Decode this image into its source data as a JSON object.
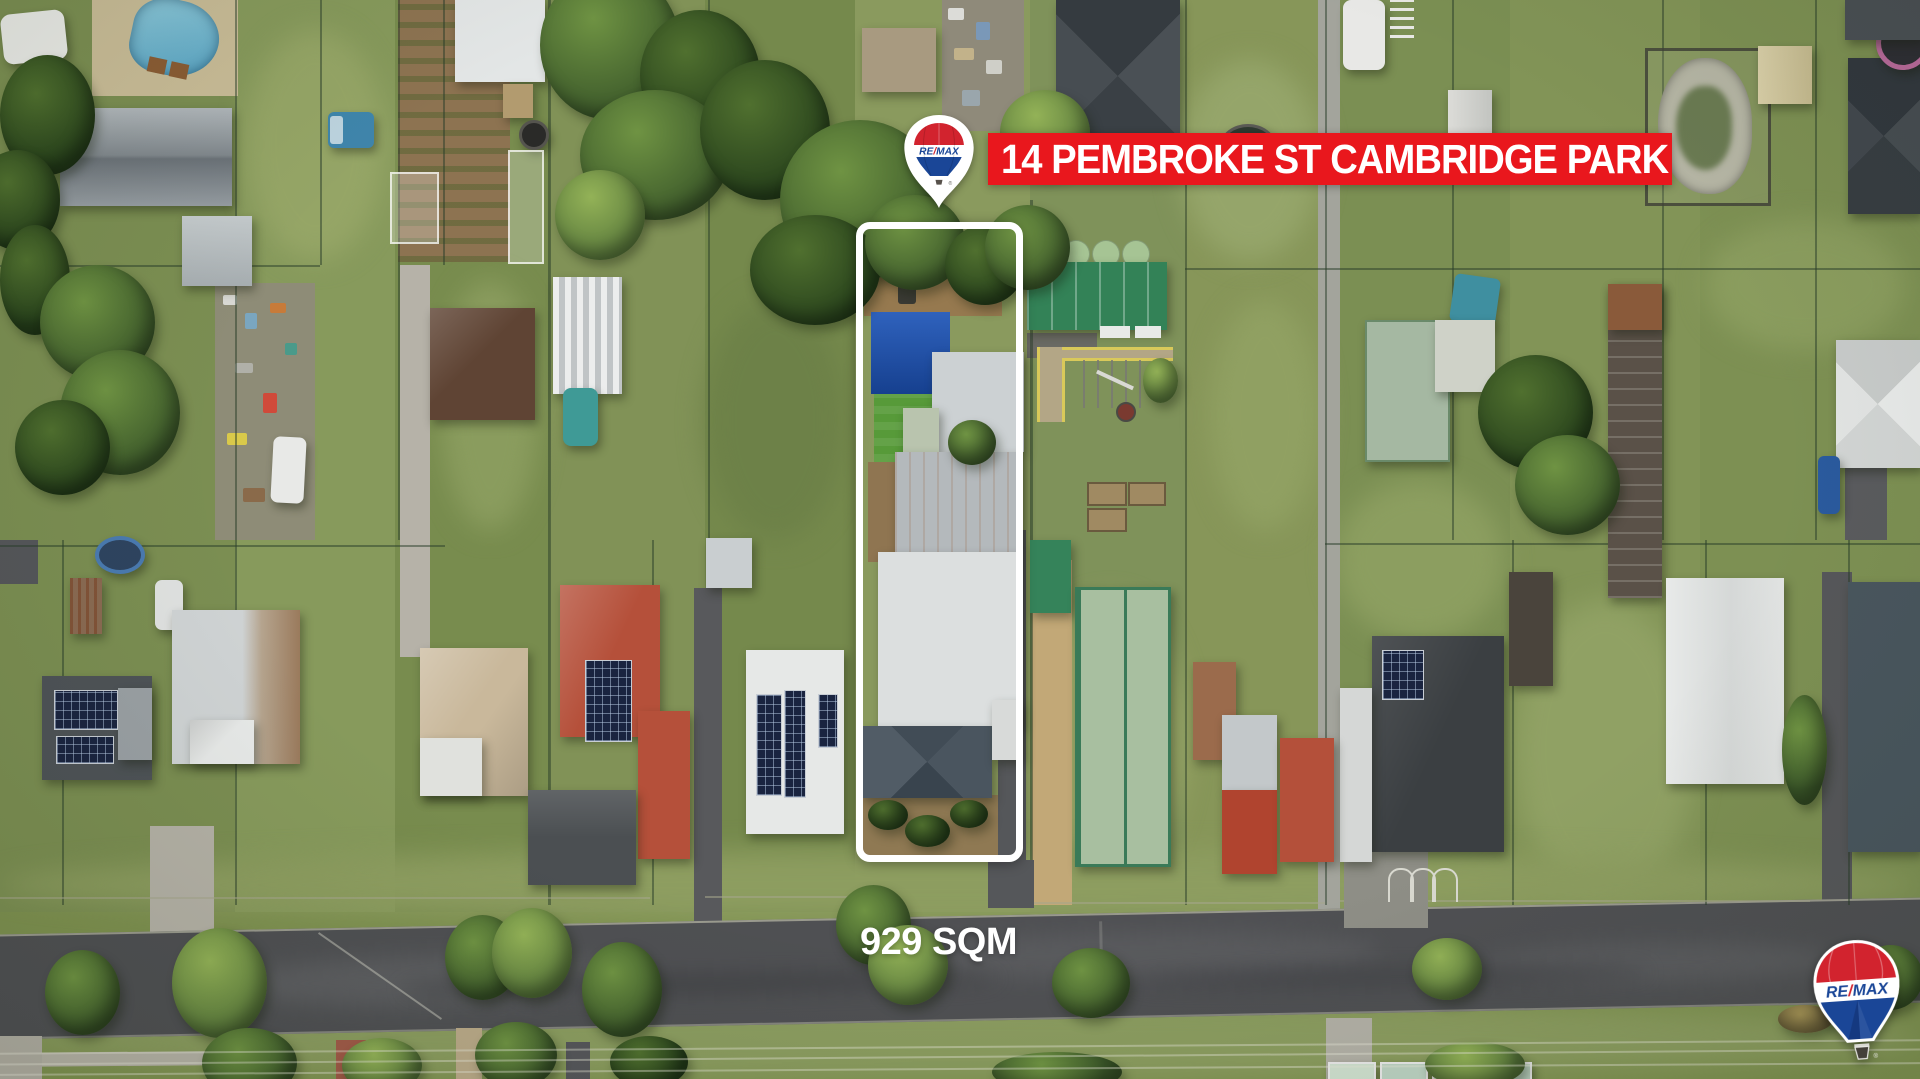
{
  "overlay": {
    "address_banner": "14 PEMBROKE ST CAMBRIDGE PARK",
    "area_label": "929 SQM",
    "brand": {
      "re": "RE",
      "slash": "/",
      "max": "MAX",
      "registered": "®"
    },
    "colors": {
      "banner_red": "#e9171d",
      "brand_red": "#d2232e",
      "brand_blue": "#1a4697",
      "boundary_white": "#ffffff",
      "label_white": "#ffffff"
    }
  }
}
